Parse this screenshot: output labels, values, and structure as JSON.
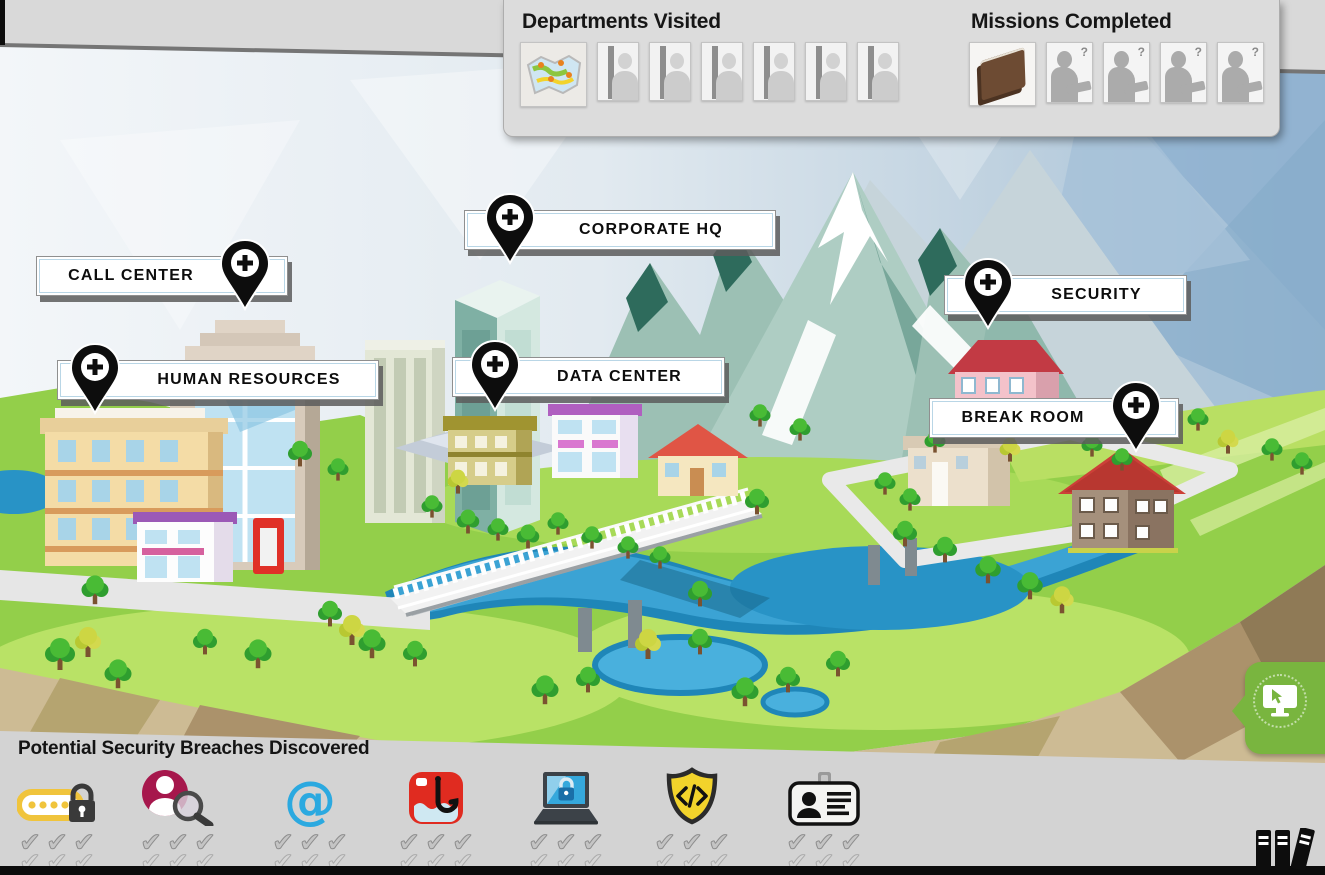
{
  "hud": {
    "departments": {
      "title": "Departments Visited",
      "tiles": [
        {
          "id": "map",
          "type": "map",
          "state": "visited"
        },
        {
          "id": "person-1",
          "type": "person",
          "state": "not-visited"
        },
        {
          "id": "person-2",
          "type": "person",
          "state": "not-visited"
        },
        {
          "id": "person-3",
          "type": "person",
          "state": "not-visited"
        },
        {
          "id": "person-4",
          "type": "person",
          "state": "not-visited"
        },
        {
          "id": "person-5",
          "type": "person",
          "state": "not-visited"
        },
        {
          "id": "person-6",
          "type": "person",
          "state": "not-visited"
        }
      ]
    },
    "missions": {
      "title": "Missions Completed",
      "unknown_badge": "?",
      "tiles": [
        {
          "id": "book",
          "type": "book",
          "state": "completed"
        },
        {
          "id": "unknown-1",
          "type": "unknown",
          "state": "incomplete"
        },
        {
          "id": "unknown-2",
          "type": "unknown",
          "state": "incomplete"
        },
        {
          "id": "unknown-3",
          "type": "unknown",
          "state": "incomplete"
        },
        {
          "id": "unknown-4",
          "type": "unknown",
          "state": "incomplete"
        }
      ]
    }
  },
  "map": {
    "locations": [
      {
        "id": "call-center",
        "label": "CALL CENTER"
      },
      {
        "id": "human-resources",
        "label": "HUMAN RESOURCES"
      },
      {
        "id": "corporate-hq",
        "label": "CORPORATE HQ"
      },
      {
        "id": "data-center",
        "label": "DATA CENTER"
      },
      {
        "id": "security",
        "label": "SECURITY"
      },
      {
        "id": "break-room",
        "label": "BREAK ROOM"
      }
    ]
  },
  "breaches": {
    "title": "Potential Security Breaches Discovered",
    "check_glyph": "✔",
    "items": [
      {
        "id": "password",
        "icon": "password-lock-icon",
        "checks": [
          3,
          3
        ]
      },
      {
        "id": "identity-search",
        "icon": "person-magnifier-icon",
        "checks": [
          3,
          3
        ]
      },
      {
        "id": "email",
        "icon": "at-symbol-icon",
        "glyph": "@",
        "checks": [
          3,
          3
        ]
      },
      {
        "id": "phishing",
        "icon": "phishing-hook-icon",
        "checks": [
          3,
          3
        ]
      },
      {
        "id": "computer-security",
        "icon": "laptop-lock-icon",
        "checks": [
          3,
          3
        ]
      },
      {
        "id": "malicious-code",
        "icon": "code-shield-icon",
        "checks": [
          3,
          3
        ]
      },
      {
        "id": "id-badge",
        "icon": "id-card-icon",
        "checks": [
          3,
          3
        ]
      }
    ]
  },
  "side_tab": {
    "icon": "monitor-cursor-icon"
  },
  "library": {
    "icon": "books-icon"
  },
  "colors": {
    "tab_green": "#79b53f",
    "pin_black": "#0d0d0d",
    "panel_gray": "#d3d3d3",
    "sky_blue": "#a9c3d8",
    "terrain_green": "#93cf4a",
    "river_blue": "#2893c6",
    "breach_red": "#e02b20",
    "breach_yellow": "#f0c43c",
    "breach_blue": "#2ba9e0",
    "breach_crimson": "#a6174c",
    "shield_yellow": "#f2d32b"
  }
}
